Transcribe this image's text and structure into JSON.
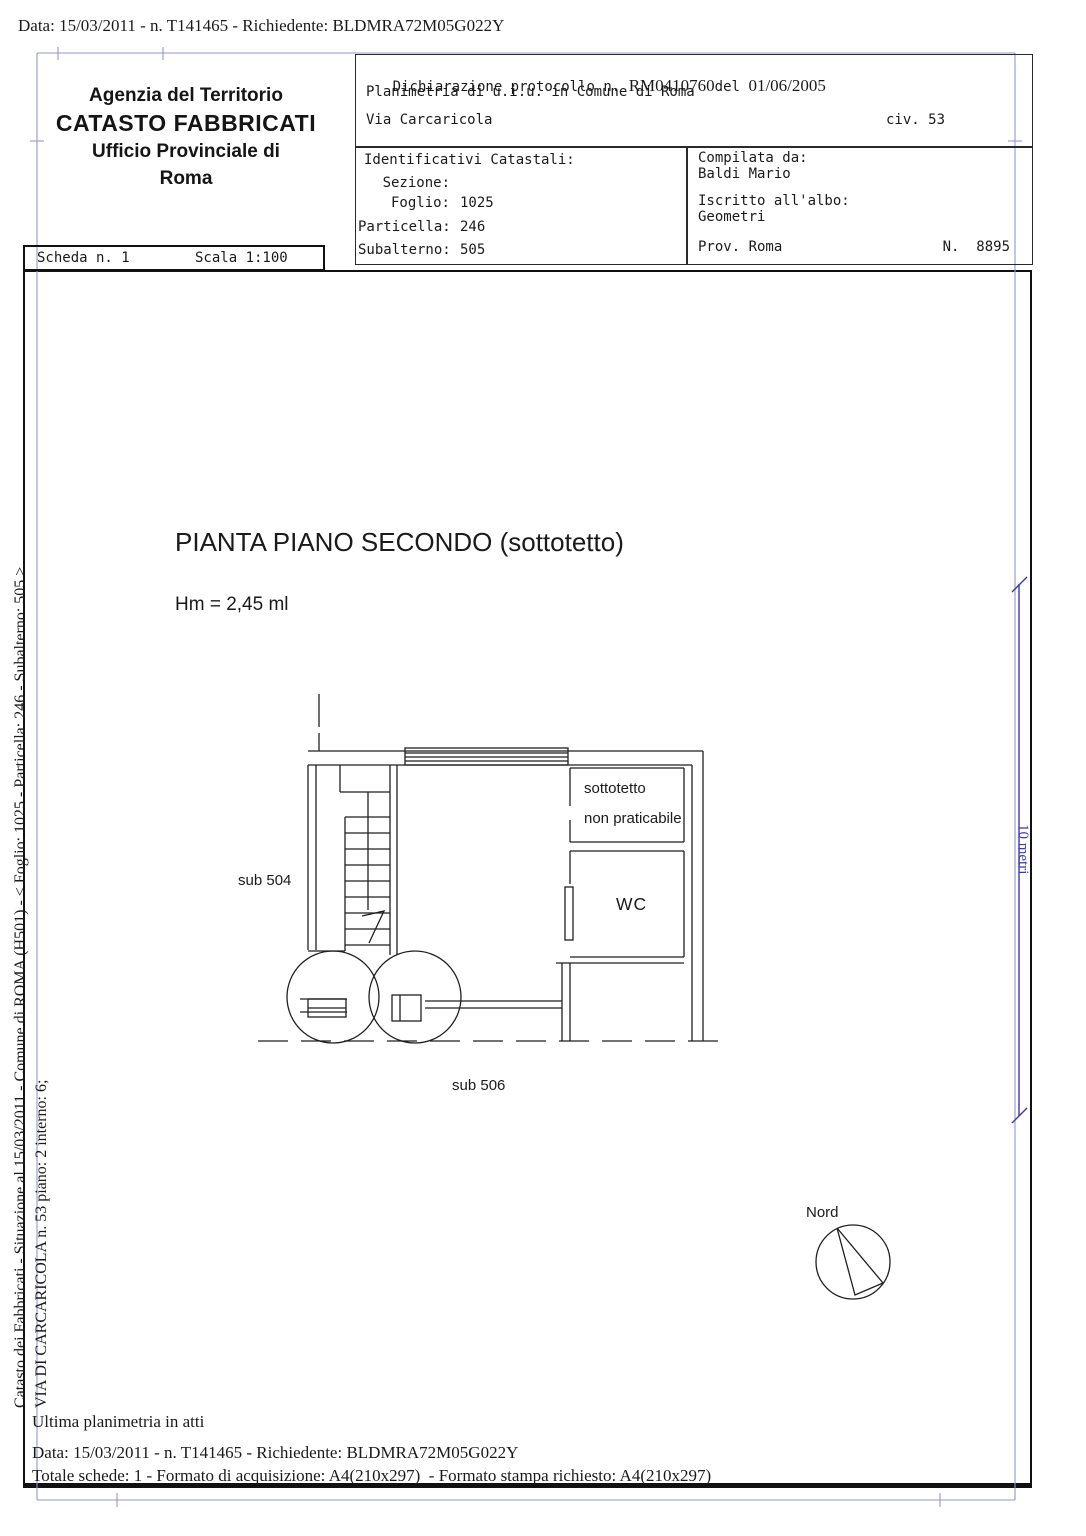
{
  "request_line": "Data: 15/03/2011 - n. T141465 - Richiedente: BLDMRA72M05G022Y",
  "header": {
    "agency": {
      "line1": "Agenzia del Territorio",
      "line2": "CATASTO FABBRICATI",
      "line3": "Ufficio Provinciale di",
      "line4": "Roma"
    },
    "declaration": {
      "protocol_label": "Dichiarazione protocollo n. ",
      "protocol_number": "RM0410760",
      "protocol_del": "del",
      "protocol_date": "  01/06/2005",
      "object_line": "Planimetria di u.i.u. in Comune di Roma",
      "street": "Via Carcaricola",
      "civic": "civ. 53"
    },
    "identifiers": {
      "title": "Identificativi Catastali:",
      "rows": [
        {
          "label": "Sezione:",
          "value": ""
        },
        {
          "label": "Foglio:",
          "value": "1025"
        },
        {
          "label": "Particella:",
          "value": "246"
        },
        {
          "label": "Subalterno:",
          "value": "505"
        }
      ]
    },
    "compiler": {
      "label": "Compilata da:",
      "name": "Baldi Mario",
      "albo_label": "Iscritto all'albo:",
      "albo_value": "Geometri",
      "prov": "Prov. Roma",
      "number": "N.  8895"
    },
    "sheet": {
      "scheda": "Scheda n. 1",
      "scala": "Scala 1:100"
    }
  },
  "sidebar": {
    "line1": "Catasto dei Fabbricati - Situazione al 15/03/2011 - Comune di ROMA (H501) - < Foglio: 1025 - Particella: 246 - Subalterno: 505 >",
    "line2": "VIA DI CARCARICOLA n. 53 piano: 2 interno: 6;"
  },
  "plan": {
    "title": "PIANTA PIANO SECONDO (sottotetto)",
    "height_note": "Hm = 2,45 ml",
    "label_sub504": "sub 504",
    "label_sub506": "sub 506",
    "label_sottotetto_1": "sottotetto",
    "label_sottotetto_2": "non praticabile",
    "label_wc": "WC",
    "label_nord": "Nord",
    "dimension_label": "10 metri",
    "scale": "1:100"
  },
  "footer": {
    "ultima": "Ultima planimetria in atti",
    "totale": "Totale schede: 1 - Formato di acquisizione: A4(210x297)  - Formato stampa richiesto: A4(210x297)"
  },
  "colors": {
    "ink": "#1a1a1a",
    "dimension_blue": "#3a3aad",
    "registration_blue": "#9296d2"
  }
}
